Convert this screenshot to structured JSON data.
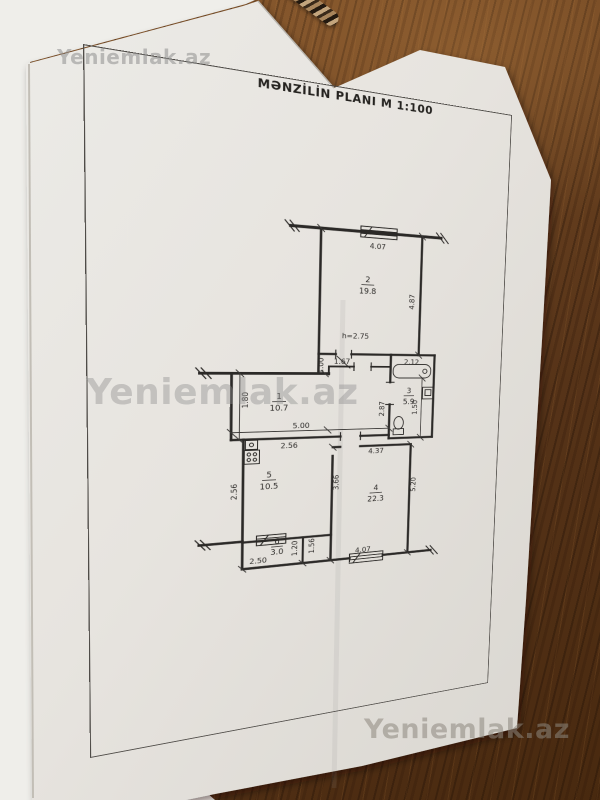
{
  "watermark": {
    "text": "Yeniemlak.az"
  },
  "plan": {
    "title": "MƏNZİLİN PLANI  M 1:100",
    "height_note": "h=2.75",
    "rooms": [
      {
        "number": "2",
        "area": "19.8"
      },
      {
        "number": "1",
        "area": "10.7"
      },
      {
        "number": "3",
        "area": "5.9"
      },
      {
        "number": "4",
        "area": "22.3"
      },
      {
        "number": "5",
        "area": "10.5"
      },
      {
        "number": "6",
        "area": "3.0"
      }
    ],
    "dims": {
      "top_width": "4.07",
      "room2_right": "4.87",
      "nook_width": "1.67",
      "bath_width": "2.12",
      "nook_height": "1.00",
      "hall_left": "1.80",
      "hall_width": "5.00",
      "bath_left": "2.87",
      "bath_inner": "1.50",
      "kitchen_top": "2.56",
      "room4_top": "4.37",
      "kitchen_right": "3.66",
      "kitchen_left": "2.56",
      "room4_right": "5.20",
      "room6_right": "1.20",
      "lobby_height": "1.56",
      "room6_width": "2.50",
      "bottom_width": "4.07"
    }
  },
  "colors": {
    "paper": "#e7e4df",
    "under_sheet": "#efeeea",
    "ink": "#2b2927",
    "wood": "#6e4522"
  }
}
